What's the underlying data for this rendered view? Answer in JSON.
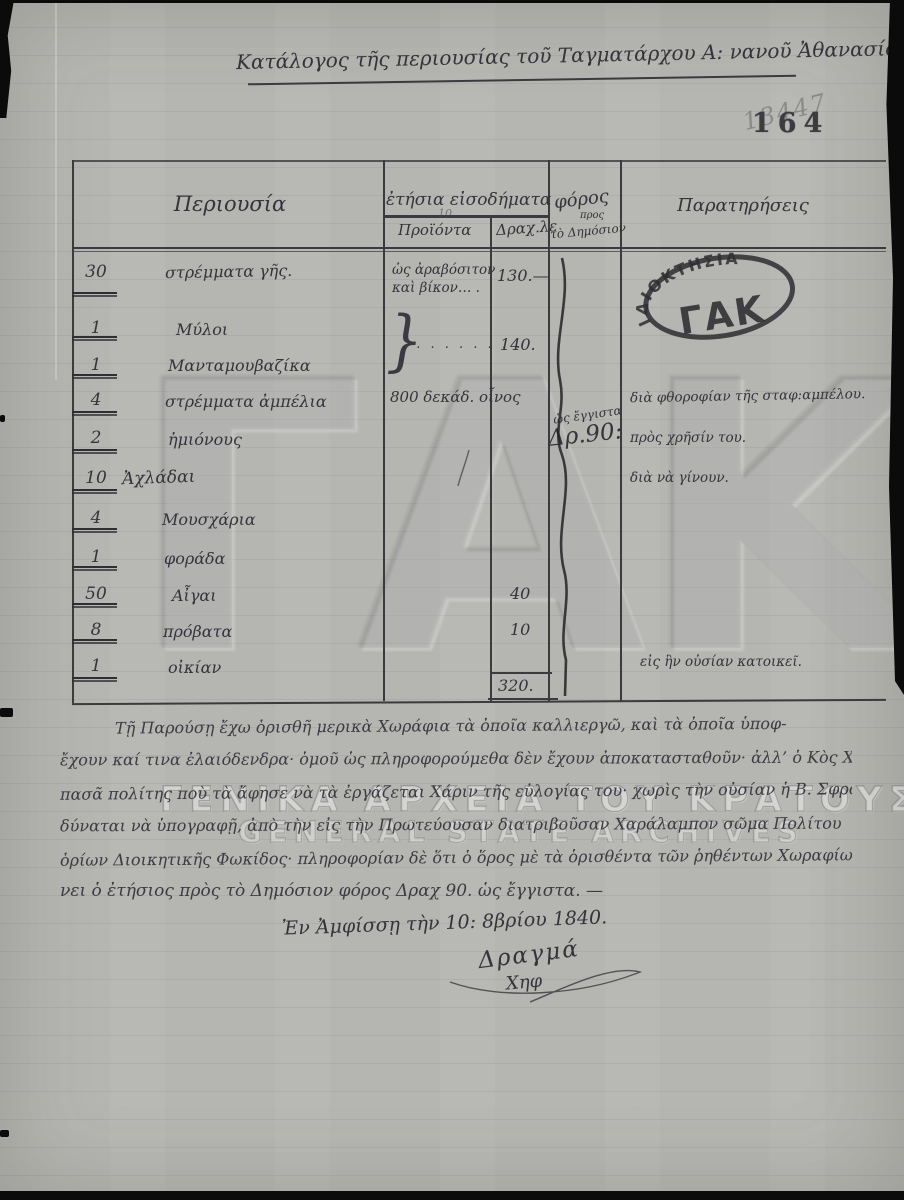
{
  "page": {
    "title": "Κατάλογος τῆς περιουσίας τοῦ Ταγματάρχου Α: νανοῦ Ἀθανασίου.",
    "page_number": "164",
    "pencil_number": "13447"
  },
  "ownership_stamp": {
    "arc_text": "ΙΔΙΟΚΤΗΣΙΑ",
    "center_text": "ΓΑΚ"
  },
  "watermark": {
    "logo": "ΓΑΚ",
    "line_greek": "ΓΕΝΙΚΑ ΑΡΧΕΙΑ ΤΟΥ ΚΡΑΤΟΥΣ",
    "line_english": "GENERAL STATE ARCHIVES"
  },
  "table": {
    "header": {
      "property": "Περιουσία",
      "annual_income": "ἐτήσια εἰσοδήματα",
      "products": "Προϊόντα",
      "products_note": "10",
      "drachmas": "Δραχ.λε",
      "tax": "φόρος",
      "tax_small": "προς",
      "tax_sub": "τὸ Δημόσιον",
      "remarks": "Παρατηρήσεις"
    },
    "rows": [
      {
        "qty": "30",
        "item": "στρέμματα γῆς."
      },
      {
        "qty": "1",
        "item": "Μύλοι"
      },
      {
        "qty": "1",
        "item": "Μανταμουβαζίκα"
      },
      {
        "qty": "4",
        "item": "στρέμματα ἀμπέλια",
        "product": "800 δεκάδ. οἶνος",
        "remark": "διὰ φθοροφίαν τῆς σταφ:αμπέλου."
      },
      {
        "qty": "2",
        "item": "ἡμιόνους",
        "remark": "πρὸς χρῆσίν του."
      },
      {
        "qty": "10",
        "item": "Ἀχλάδαι",
        "remark": "διὰ νὰ γίνουν."
      },
      {
        "qty": "4",
        "item": "Μουσχάρια"
      },
      {
        "qty": "1",
        "item": "φοράδα"
      },
      {
        "qty": "50",
        "item": "Αἶγαι",
        "drachmas": "40"
      },
      {
        "qty": "8",
        "item": "πρόβατα",
        "drachmas": "10"
      },
      {
        "qty": "1",
        "item": "οἰκίαν",
        "remark": "εἰς ἣν οὐσίαν κατοικεῖ."
      }
    ],
    "row1_product_line1": "ὡς ἀραβόσιτον",
    "row1_product_line2": "καὶ βίκον… .",
    "row1_drachmas": "130.—",
    "brace": "}",
    "mill_dots": ". . . . . . . . .",
    "joint_value": "140.",
    "tax_note_small": "ὡς ἔγγιστα",
    "tax_value": "Δρ.90:",
    "total": "320."
  },
  "body": {
    "lines": [
      "Τῇ Παρούσῃ ἔχω ὁρισθῆ μερικὰ Χωράφια τὰ ὁποῖα καλλιεργῶ, καὶ τὰ ὁποῖα ὑποφ-",
      "ἔχουν καί τινα ἐλαιόδενδρα· ὁμοῦ ὡς πληροφορούμεθα δὲν ἔχουν ἀποκατασταθοῦν· ἀλλ’ ὁ Κὸς Χαράλαμπος",
      "πασᾶ πολίτης ποὺ τὰ ἄφησε νὰ τὰ ἐργάζεται Χάριν τῆς εὐλογίας του· χωρὶς τὴν οὐσίαν ἡ Β. Σφραγὶς",
      "δύναται νὰ ὑπογραφῇ, ἀπὸ τὴν εἰς τὴν Πρωτεύουσαν διατριβοῦσαν Χαράλαμπον σῶμα Πολίτου",
      "ὁρίων Διοικητικῆς Φωκίδος· πληροφορίαν δὲ ὅτι ὁ ὅρος μὲ τὰ ὁρισθέντα τῶν ῥηθέντων Χωραφίων ἀναβαί-",
      "νει ὁ ἐτήσιος πρὸς τὸ Δημόσιον φόρος Δραχ 90. ὡς ἔγγιστα. —"
    ]
  },
  "closing": {
    "place_date": "Ἐν Ἀμφίσσῃ τὴν 10: 8βρίου 1840.",
    "signature_line1": "Δραγμά",
    "signature_line2": "Χηφ"
  }
}
